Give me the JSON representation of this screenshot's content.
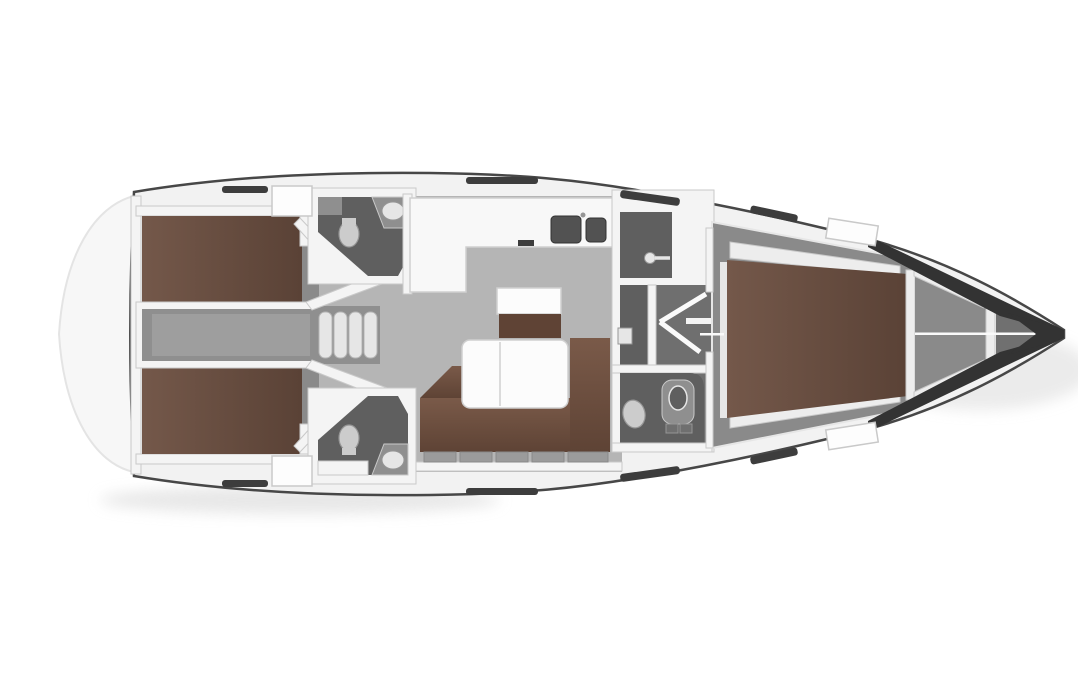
{
  "figure": {
    "subject": "sailboat-interior-floor-plan",
    "view": "top-down",
    "bow_direction": "right",
    "rooms": [
      "aft-cabin-port",
      "aft-cabin-starboard",
      "engine-walkway",
      "companionway-steps",
      "head-port",
      "head-starboard",
      "galley",
      "chart-table",
      "salon-dinette",
      "shower-compartment",
      "corridor",
      "forward-head",
      "forward-cabin",
      "anchor-locker",
      "bow-tip",
      "stern-platform"
    ],
    "fixtures": [
      "double-bed",
      "double-bed",
      "v-bed",
      "u-sofa",
      "salon-table",
      "galley-sinks",
      "stove",
      "toilet",
      "toilet",
      "toilet",
      "washbasin",
      "washbasin",
      "washbasin",
      "shower-head",
      "deck-hatch",
      "deck-window-slot",
      "cabin-door-swing"
    ]
  },
  "palette": {
    "background": "#ffffff",
    "hullFill": "#f2f2f2",
    "hullStroke": "#474747",
    "sternGhost": "#f7f7f7",
    "sternGhostLine": "#e4e4e4",
    "wallWhite": "#f4f4f4",
    "wallStroke": "#c9c9c9",
    "deckHatch": "#fdfdfd",
    "slotDark": "#3d3d3d",
    "salonFloor": "#b5b5b5",
    "walkwayFloor": "#8f8f8f",
    "walkwayInner": "#9e9e9e",
    "cabinFloor": "#8a8a8a",
    "bathFloor": "#5f5f5f",
    "corridorFloor": "#6f6f6f",
    "tipLocker": "#707070",
    "bedBrownLight": "#74584a",
    "bedBrownDark": "#5a4236",
    "sofaBrownLight": "#7a5a49",
    "sofaBrownDark": "#5e4335",
    "benchBrown": "#5f4335",
    "tableWhite": "#fcfcfc",
    "tableStroke": "#d0d0d0",
    "counterWhite": "#f8f8f8",
    "sinkDark": "#525252",
    "fixtureLight": "#cccccc",
    "fixtureStroke": "#969696",
    "cabinetGray": "#8f8f8f",
    "stepTread": "#e6e6e6",
    "stepStroke": "#b5b5b5",
    "bowDark": "#333333",
    "shadow": "#dedede",
    "centerLine": "#fafafa",
    "shelfWhite": "#ededed",
    "lockerRow": "#9b9b9b"
  }
}
